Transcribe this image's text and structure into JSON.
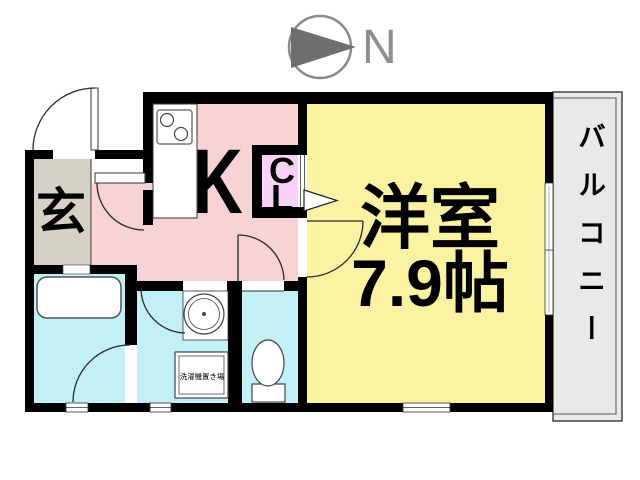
{
  "compass": {
    "north_label": "N"
  },
  "plan": {
    "entrance_label": "玄",
    "kitchen_label": "K",
    "closet_label_line1": "C",
    "closet_label_line2": "L",
    "room_name": "洋室",
    "room_size": "7.9帖",
    "balcony_label": "バルコニー",
    "laundry_label": "洗濯機置き場"
  },
  "colors": {
    "kitchen": "#f8d3d3",
    "entrance_floor": "#d5d1c5",
    "western_room": "#fbf3a2",
    "wet_rooms": "#c3f0f4",
    "closet": "#f8d2f8",
    "balcony": "#e9e9e9",
    "wall": "#000000",
    "compass_gray": "#8a8a8a"
  }
}
